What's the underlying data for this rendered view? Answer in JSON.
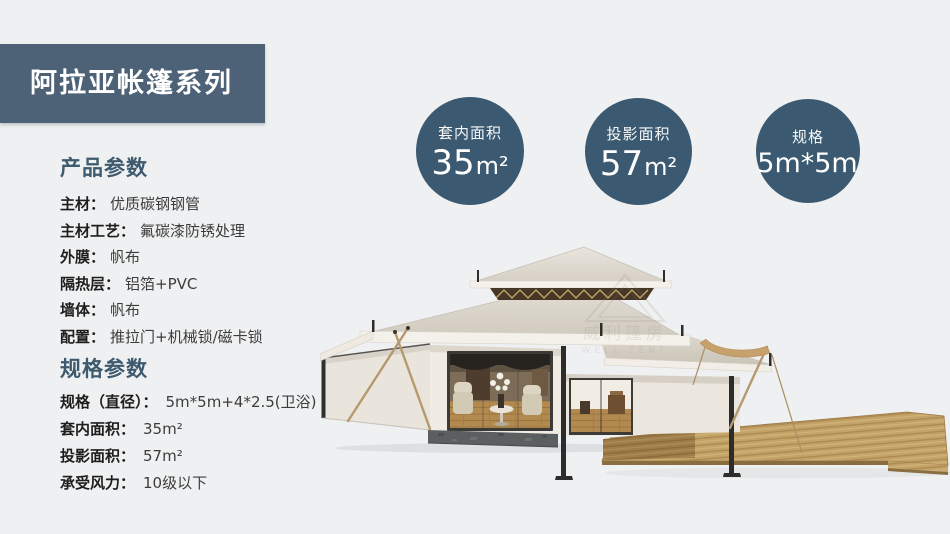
{
  "colors": {
    "background": "#eff0f1",
    "banner": "#4d6277",
    "banner_text": "#ffffff",
    "heading": "#3e5a6e",
    "label": "#1e1e1e",
    "value": "#3c3c3c",
    "badge": "#3b5a71",
    "badge_text": "#ffffff"
  },
  "banner": {
    "title": "阿拉亚帐篷系列"
  },
  "product_params": {
    "heading": "产品参数",
    "items": [
      {
        "label": "主材：",
        "value": "优质碳钢钢管"
      },
      {
        "label": "主材工艺：",
        "value": "氟碳漆防锈处理"
      },
      {
        "label": "外膜：",
        "value": "帆布"
      },
      {
        "label": "隔热层：",
        "value": "铝箔+PVC"
      },
      {
        "label": "墙体：",
        "value": "帆布"
      },
      {
        "label": "配置：",
        "value": "推拉门+机械锁/磁卡锁"
      }
    ]
  },
  "spec_params": {
    "heading": "规格参数",
    "items": [
      {
        "label": "规格（直径）：",
        "value": "5m*5m+4*2.5(卫浴)"
      },
      {
        "label": "套内面积：",
        "value": "35m²"
      },
      {
        "label": "投影面积：",
        "value": "57m²"
      },
      {
        "label": "承受风力：",
        "value": "10级以下"
      }
    ]
  },
  "badges": [
    {
      "label": "套内面积",
      "value": "35",
      "unit": "m²"
    },
    {
      "label": "投影面积",
      "value": "57",
      "unit": "m²"
    },
    {
      "label": "规格",
      "value": "5m*5m",
      "unit": ""
    }
  ],
  "tent": {
    "watermark_cn": "威利篷房",
    "watermark_en": "WELL TENT"
  }
}
